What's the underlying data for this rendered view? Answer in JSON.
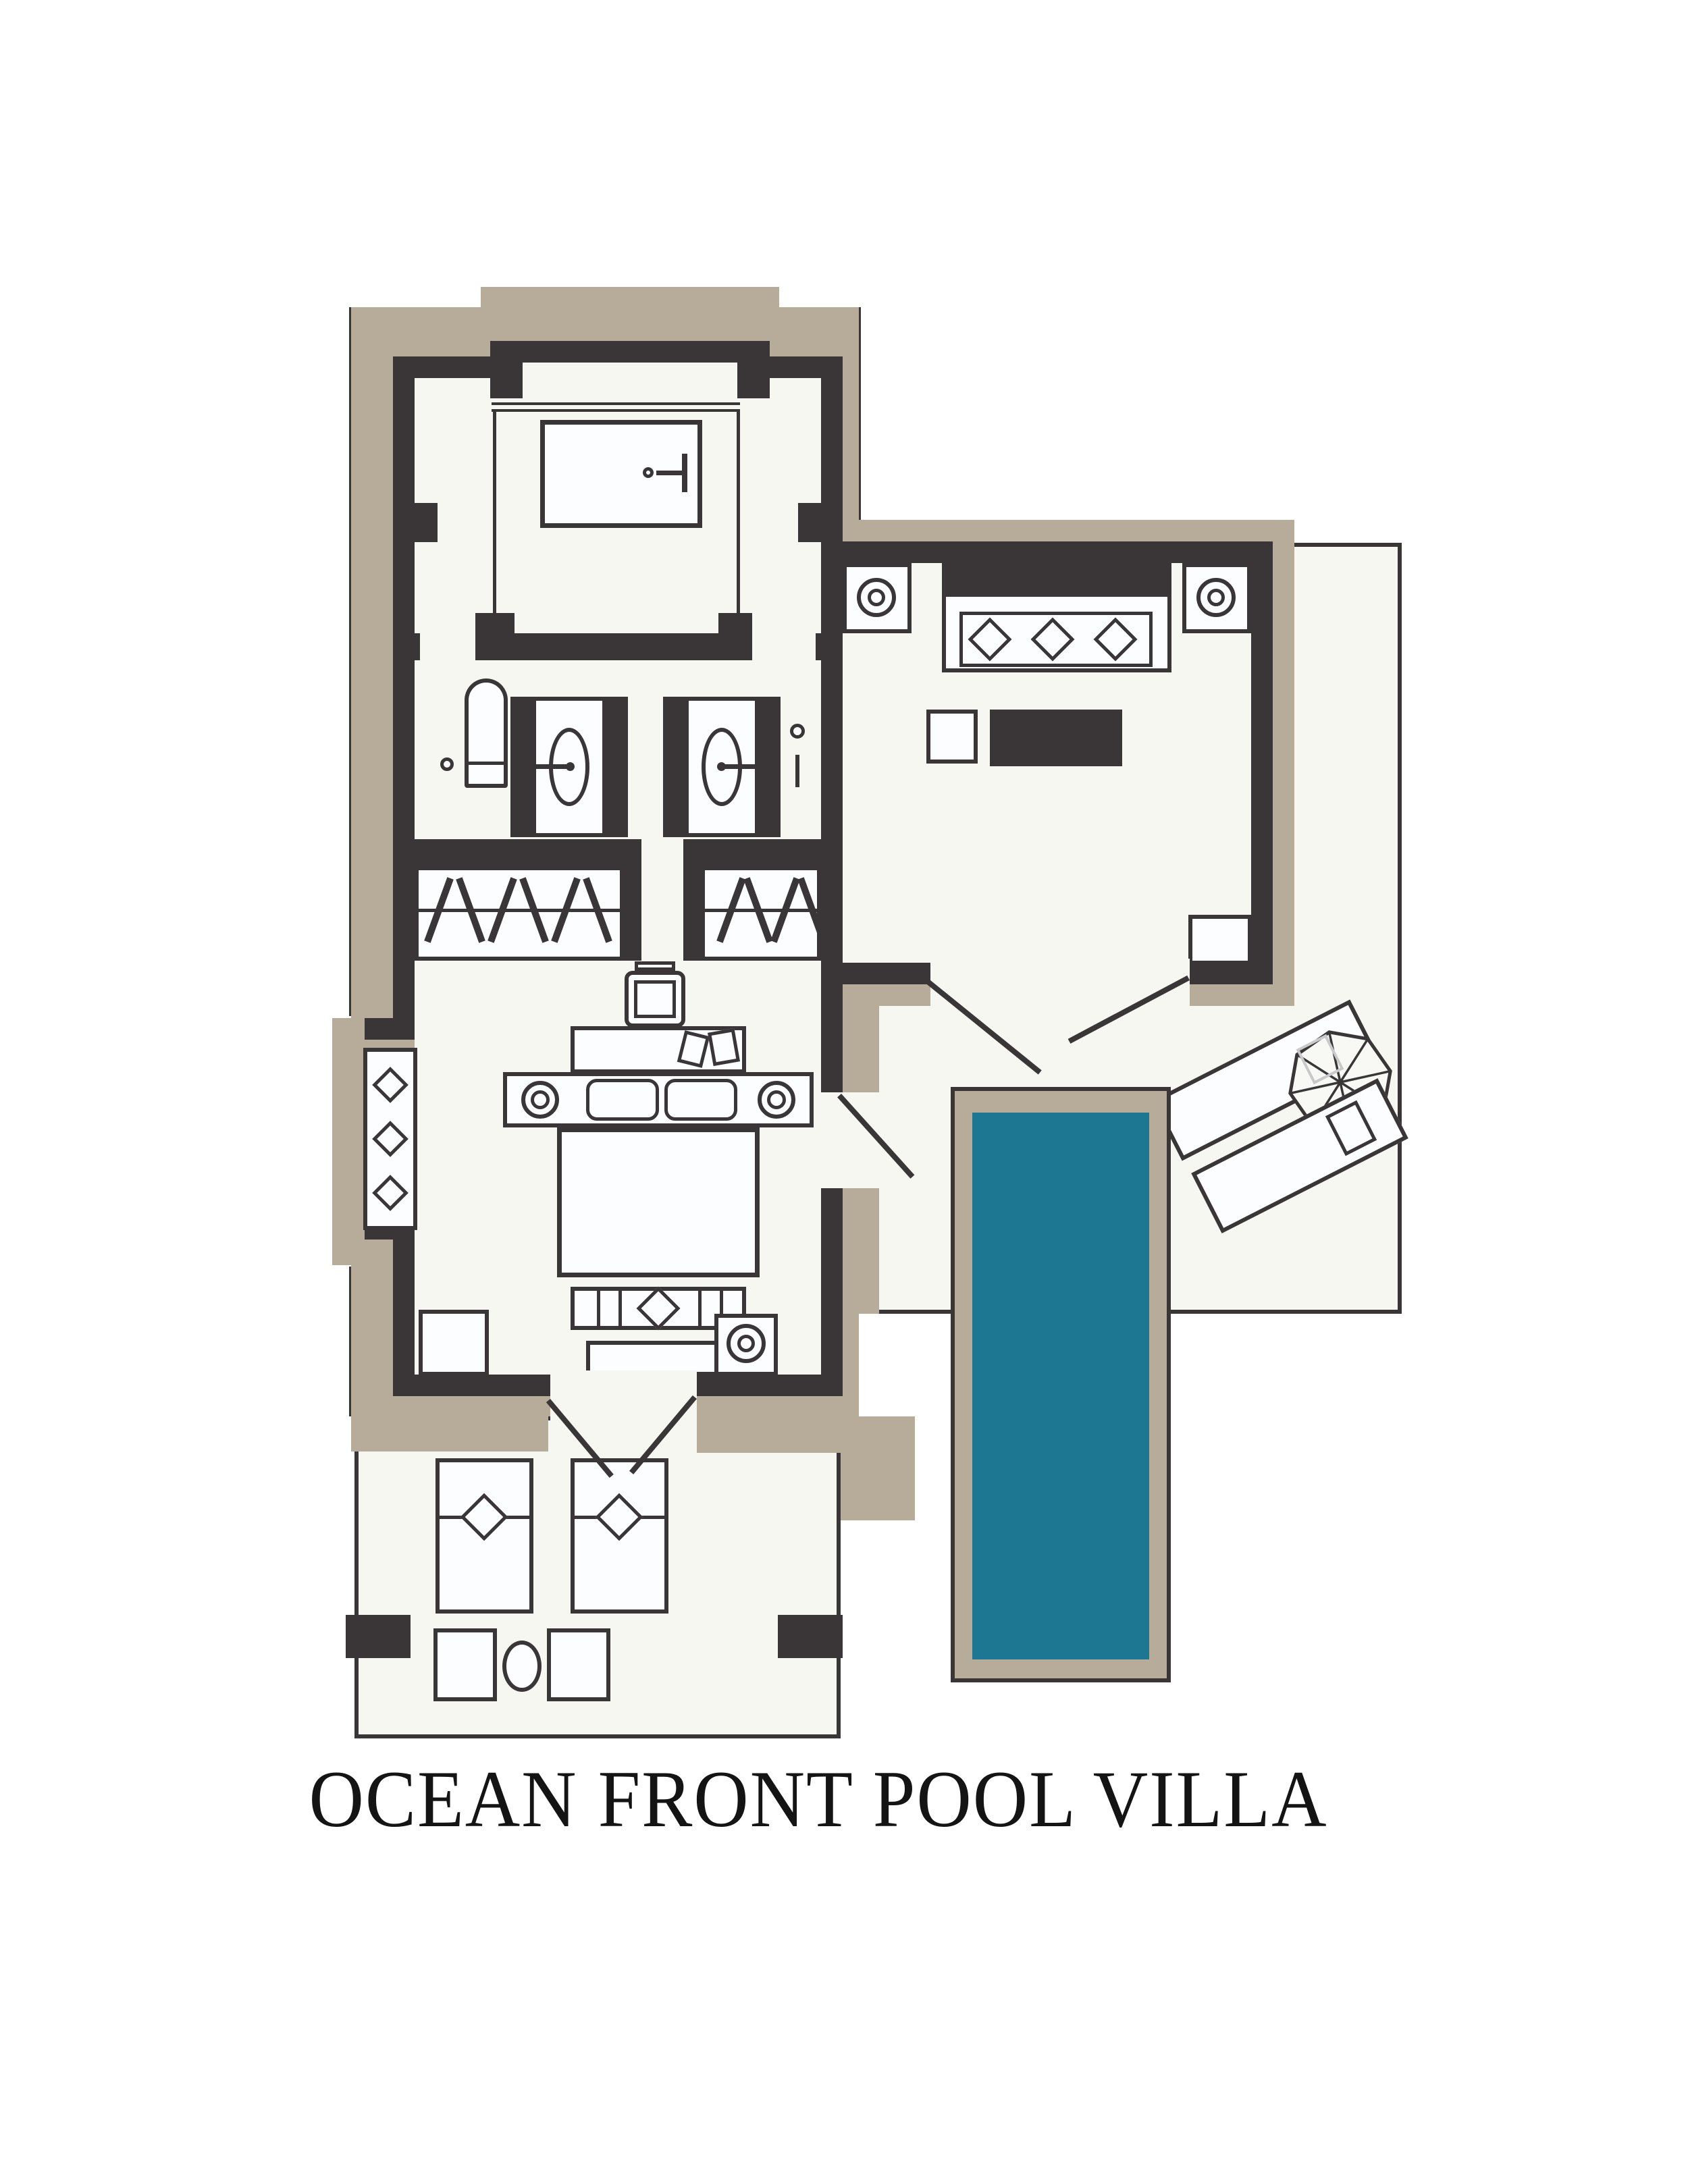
{
  "title": {
    "text": "OCEAN FRONT POOL VILLA"
  },
  "palette": {
    "background": "#ffffff",
    "floor": "#f6f7f1",
    "wall_dark": "#3a3637",
    "wall_tan": "#b7ab99",
    "furniture_fill": "#fbfdff",
    "pool_water": "#1d7793",
    "muted_line": "#c9c9c9",
    "title_color": "#141414"
  },
  "plan": {
    "label": "Ocean front pool villa floor plan",
    "areas": [
      "bathroom",
      "dressing-area",
      "bedroom",
      "living-pavilion",
      "outdoor-terrace",
      "swimming-pool",
      "sun-deck"
    ],
    "elements": {
      "bathtub": 1,
      "toilet": 1,
      "sinks": 2,
      "shower": 1,
      "wardrobes": 2,
      "bed": 1,
      "desk-chair": 1,
      "bedside-lamps": 2,
      "pillows": 2,
      "bench": 1,
      "tv-table": 1,
      "window-daybed": 1,
      "sofa": 1,
      "sofa-cushions": 3,
      "coffee-table": 1,
      "lamp-tables": 2,
      "side-tables": 3,
      "pool-loungers": 2,
      "umbrella": 1,
      "deck-loungers": 2,
      "ottomans": 2,
      "round-table": 1,
      "door-leaves": 5
    }
  }
}
